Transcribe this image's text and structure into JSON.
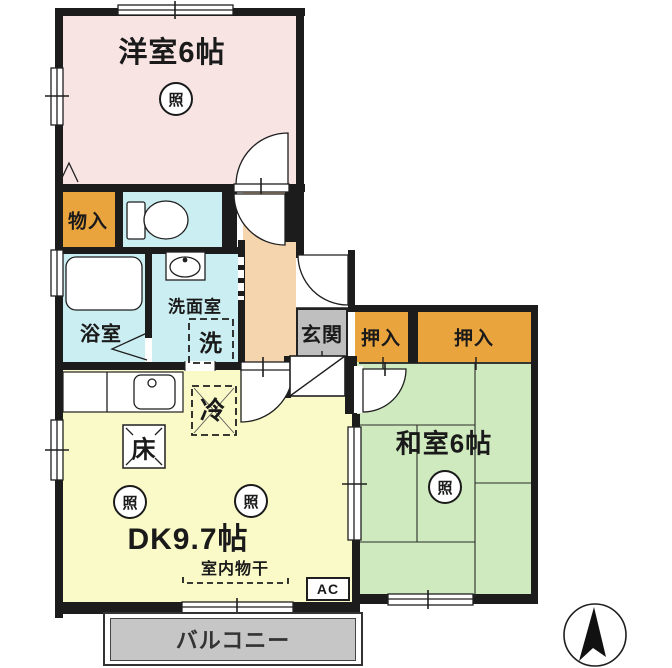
{
  "title": "2DK apartment floor plan",
  "rooms": {
    "western_room": "洋室6帖",
    "japanese_room": "和室6帖",
    "dining_kitchen": "DK9.7帖",
    "storage": "物入",
    "bath": "浴室",
    "washroom": "洗面室",
    "entrance": "玄関",
    "closet_1": "押入",
    "closet_2": "押入",
    "balcony": "バルコニー"
  },
  "symbols": {
    "light": "照",
    "refrigerator": "冷",
    "floor_alcove": "床",
    "washer": "洗",
    "indoor_drying": "室内物干",
    "air_conditioner": "AC"
  },
  "colors": {
    "western-room": "#f9e4e4",
    "closet-orange": "#eaa43e",
    "wet-area-cyan": "#cbeef2",
    "corridor-peach": "#f5d5ae",
    "entrance-gray": "#bfbfbf",
    "japanese-room-green": "#cfeabe",
    "dk-yellow": "#fafac8",
    "balcony": "#c6c6c6",
    "wall": "#1c1c1c"
  }
}
